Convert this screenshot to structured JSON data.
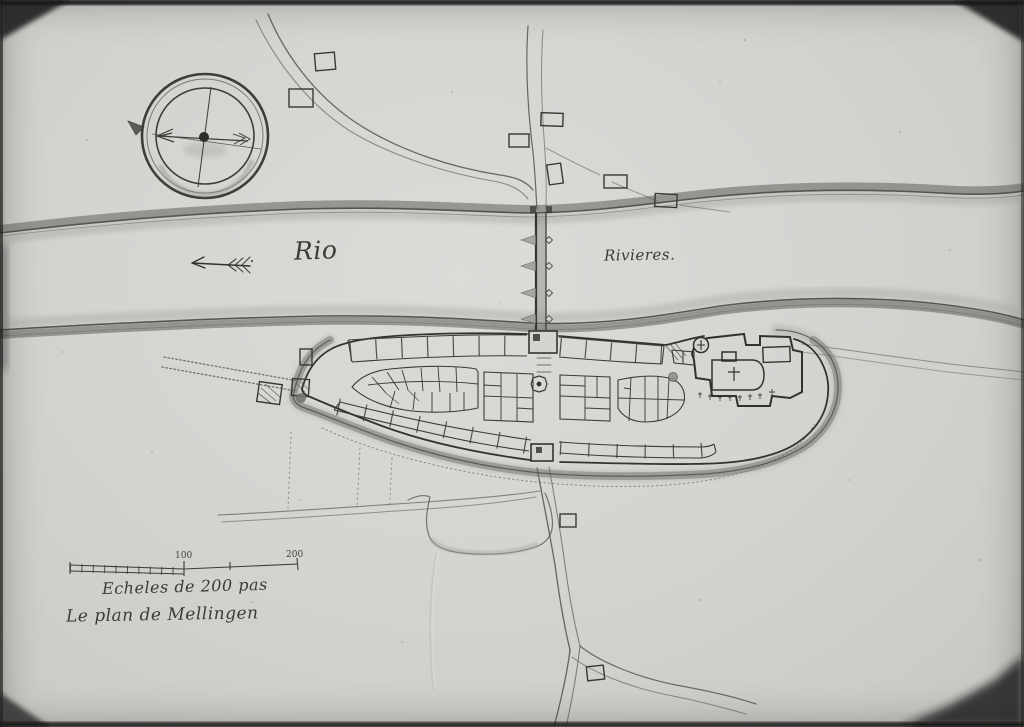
{
  "map": {
    "title": "Le plan de Mellingen",
    "scale": {
      "caption": "Echeles de 200 pas",
      "tick_mid": "100",
      "tick_end": "200"
    },
    "river": {
      "label_left": "Rio",
      "label_right": "Rivieres."
    },
    "colors": {
      "paper": "#d5d4d1",
      "ink": "#3a3835",
      "wash": "#a3a29e",
      "photo_border": "#141412"
    }
  }
}
